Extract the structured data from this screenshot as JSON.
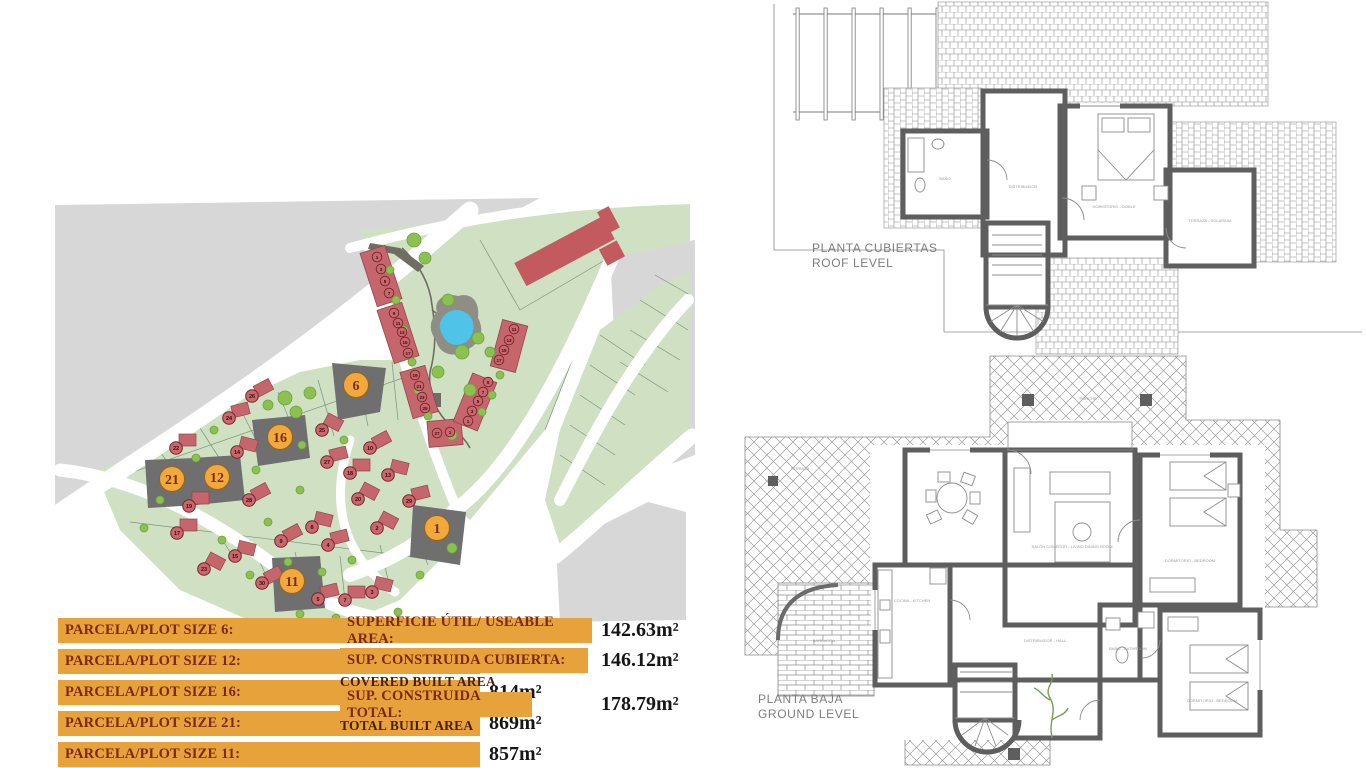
{
  "plot_sizes": [
    {
      "label": "PARCELA/PLOT SIZE 6:",
      "value": "814m²"
    },
    {
      "label": "PARCELA/PLOT SIZE 12:",
      "value": "802m²"
    },
    {
      "label": "PARCELA/PLOT SIZE 16:",
      "value": "814m²"
    },
    {
      "label": "PARCELA/PLOT SIZE 21:",
      "value": "869m²"
    },
    {
      "label": "PARCELA/PLOT SIZE 11:",
      "value": "857m²"
    }
  ],
  "areas": [
    {
      "label": "SUPERFICIE ÚTIL/ USEABLE AREA:",
      "value": "142.63m²",
      "sublabel": ""
    },
    {
      "label": "SUP. CONSTRUIDA CUBIERTA:",
      "value": "146.12m²",
      "sublabel": "COVERED BUILT AREA"
    },
    {
      "label": "SUP. CONSTRUIDA TOTAL:",
      "value": "178.79m²",
      "sublabel": "TOTAL BUILT AREA"
    }
  ],
  "floor_plans": {
    "roof": {
      "title_es": "PLANTA CUBIERTAS",
      "title_en": "ROOF LEVEL",
      "room_labels": [
        {
          "t": "BAÑO",
          "x": 945,
          "y": 180
        },
        {
          "t": "DISTRIBUIDOR",
          "x": 1023,
          "y": 188
        },
        {
          "t": "DORMITORIO - DOBLE",
          "x": 1114,
          "y": 208
        },
        {
          "t": "TERRAZA - SOLARIUM",
          "x": 1210,
          "y": 222
        }
      ]
    },
    "ground": {
      "title_es": "PLANTA BAJA",
      "title_en": "GROUND LEVEL",
      "room_labels": [
        {
          "t": "PORCHE",
          "x": 1088,
          "y": 400
        },
        {
          "t": "TERRAZA",
          "x": 800,
          "y": 470
        },
        {
          "t": "BARBACOA",
          "x": 824,
          "y": 642
        },
        {
          "t": "COCINA - KITCHEN",
          "x": 912,
          "y": 602
        },
        {
          "t": "SALÓN COMEDOR - LIVING DINING ROOM",
          "x": 1072,
          "y": 548
        },
        {
          "t": "DISTRIBUIDOR - HALL",
          "x": 1045,
          "y": 642
        },
        {
          "t": "BAÑO - BATHROOM",
          "x": 1128,
          "y": 650
        },
        {
          "t": "DORMITORIO - BEDROOM",
          "x": 1190,
          "y": 562
        },
        {
          "t": "DORMITORIO - BEDROOM",
          "x": 1212,
          "y": 702
        }
      ]
    }
  },
  "site_plan": {
    "highlighted_plots": [
      {
        "n": "6",
        "x": 356,
        "y": 385
      },
      {
        "n": "16",
        "x": 280,
        "y": 437
      },
      {
        "n": "21",
        "x": 172,
        "y": 479
      },
      {
        "n": "12",
        "x": 217,
        "y": 477
      },
      {
        "n": "11",
        "x": 292,
        "y": 581
      },
      {
        "n": "1",
        "x": 437,
        "y": 528
      }
    ],
    "house_markers": [
      {
        "n": "26",
        "x": 252,
        "y": 396
      },
      {
        "n": "24",
        "x": 229,
        "y": 418
      },
      {
        "n": "22",
        "x": 176,
        "y": 448
      },
      {
        "n": "14",
        "x": 237,
        "y": 452
      },
      {
        "n": "25",
        "x": 322,
        "y": 430
      },
      {
        "n": "10",
        "x": 370,
        "y": 448
      },
      {
        "n": "27",
        "x": 327,
        "y": 462
      },
      {
        "n": "18",
        "x": 350,
        "y": 473
      },
      {
        "n": "13",
        "x": 388,
        "y": 475
      },
      {
        "n": "20",
        "x": 358,
        "y": 499
      },
      {
        "n": "28",
        "x": 249,
        "y": 500
      },
      {
        "n": "29",
        "x": 409,
        "y": 501
      },
      {
        "n": "19",
        "x": 189,
        "y": 506
      },
      {
        "n": "8",
        "x": 312,
        "y": 527
      },
      {
        "n": "2",
        "x": 377,
        "y": 528
      },
      {
        "n": "9",
        "x": 281,
        "y": 541
      },
      {
        "n": "4",
        "x": 328,
        "y": 545
      },
      {
        "n": "17",
        "x": 177,
        "y": 533
      },
      {
        "n": "15",
        "x": 235,
        "y": 556
      },
      {
        "n": "23",
        "x": 204,
        "y": 569
      },
      {
        "n": "30",
        "x": 262,
        "y": 583
      },
      {
        "n": "5",
        "x": 318,
        "y": 599
      },
      {
        "n": "7",
        "x": 345,
        "y": 600
      },
      {
        "n": "3",
        "x": 372,
        "y": 592
      }
    ],
    "townhouse_markers": [
      {
        "n": "1",
        "x": 377,
        "y": 257
      },
      {
        "n": "3",
        "x": 381,
        "y": 269
      },
      {
        "n": "5",
        "x": 385,
        "y": 281
      },
      {
        "n": "7",
        "x": 389,
        "y": 293
      },
      {
        "n": "9",
        "x": 394,
        "y": 313
      },
      {
        "n": "11",
        "x": 398,
        "y": 323
      },
      {
        "n": "13",
        "x": 402,
        "y": 332
      },
      {
        "n": "15",
        "x": 405,
        "y": 342
      },
      {
        "n": "17",
        "x": 408,
        "y": 353
      },
      {
        "n": "19",
        "x": 415,
        "y": 375
      },
      {
        "n": "21",
        "x": 419,
        "y": 386
      },
      {
        "n": "23",
        "x": 422,
        "y": 397
      },
      {
        "n": "25",
        "x": 425,
        "y": 408
      },
      {
        "n": "27",
        "x": 437,
        "y": 433
      },
      {
        "n": "1",
        "x": 450,
        "y": 432
      },
      {
        "n": "11",
        "x": 514,
        "y": 329
      },
      {
        "n": "13",
        "x": 509,
        "y": 340
      },
      {
        "n": "15",
        "x": 504,
        "y": 350
      },
      {
        "n": "17",
        "x": 499,
        "y": 360
      },
      {
        "n": "9",
        "x": 488,
        "y": 382
      },
      {
        "n": "7",
        "x": 483,
        "y": 392
      },
      {
        "n": "5",
        "x": 478,
        "y": 401
      },
      {
        "n": "3",
        "x": 472,
        "y": 411
      },
      {
        "n": "1",
        "x": 468,
        "y": 421
      }
    ]
  },
  "colors": {
    "label_bar": "#E8A23B",
    "label_text": "#7A2A17",
    "value_text": "#161616",
    "plot_green": "#cfe0c3",
    "land_gray": "#d7d7d7",
    "house_red": "#c4666c",
    "pool_blue": "#4FC4E8",
    "highlight_gray": "#6f6f6f",
    "highlight_circle": "#F1A83C",
    "tree_green": "#8CC152",
    "wall_gray": "#5e5e5e"
  }
}
